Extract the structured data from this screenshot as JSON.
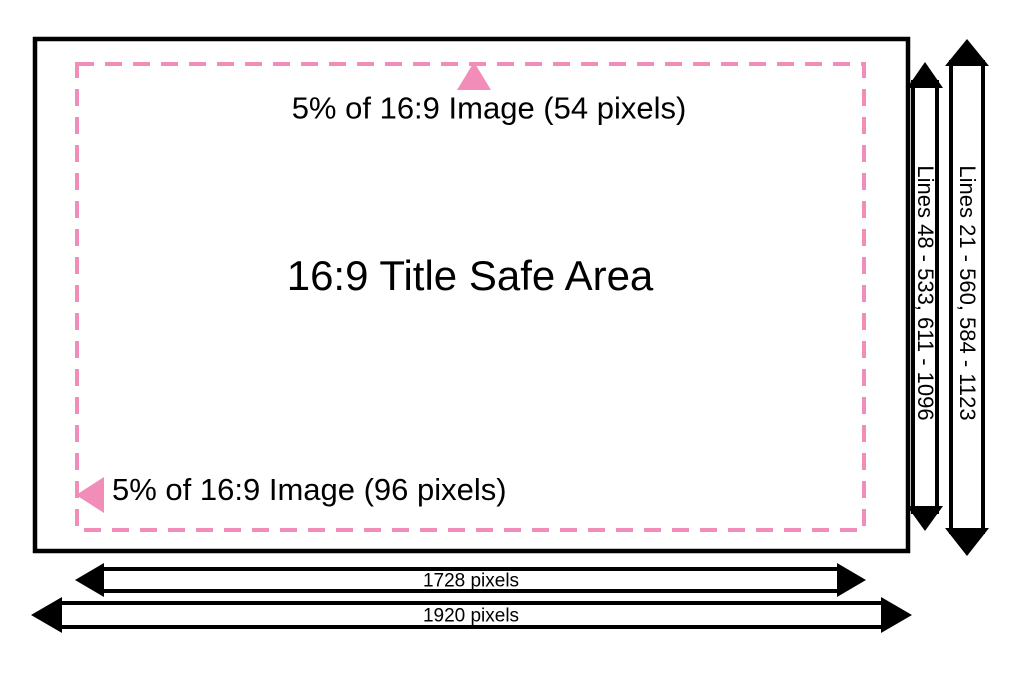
{
  "colors": {
    "accent_pink": "#F28CB8",
    "line_black": "#000000",
    "background": "#FFFFFF"
  },
  "diagram": {
    "title": "16:9 Title Safe Area",
    "top_margin_label": "5% of 16:9 Image (54 pixels)",
    "left_margin_label": "5% of 16:9 Image (96 pixels)",
    "safe_area_lines_label": "Lines 48 - 533, 611 - 1096",
    "image_lines_label": "Lines 21 - 560, 584 - 1123",
    "safe_area_width_label": "1728 pixels",
    "image_width_label": "1920 pixels"
  }
}
